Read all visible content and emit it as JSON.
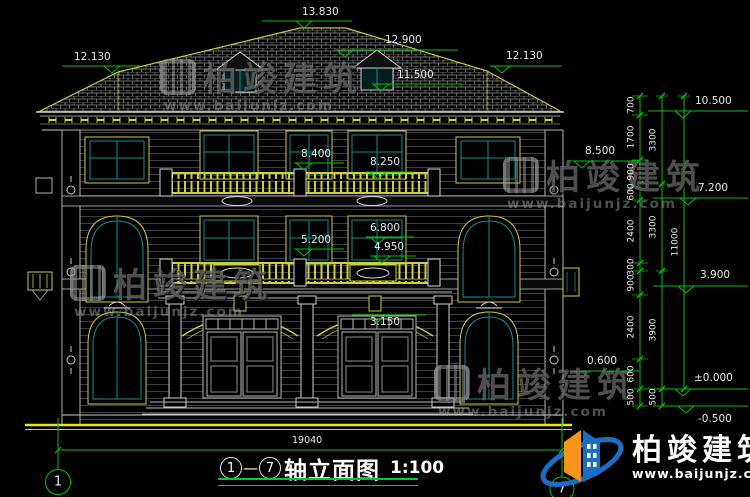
{
  "title": {
    "axis_start": "1",
    "separator": "—",
    "axis_end": "7",
    "name": "轴立面图",
    "scale": "1:100"
  },
  "axes": {
    "left": "1",
    "right": "7"
  },
  "elev": {
    "ridge": "13.830",
    "roof_left": "12.130",
    "roof_right": "12.130",
    "dormer_top": "12.900",
    "dormer_base": "11.500",
    "balcony3_front": "8.400",
    "balcony3_back": "8.250",
    "f2_header": "6.800",
    "f2_sill": "5.200",
    "balcony2": "4.950",
    "entry_arch": "3.150",
    "eave_right": "10.500",
    "r_8500": "8.500",
    "r_7200": "7.200",
    "r_3900": "3.900",
    "r_0600": "0.600",
    "ground": "±0.000",
    "basement": "-0.500"
  },
  "dims": {
    "inner": [
      "700",
      "1700",
      "900",
      "600",
      "2400",
      "300",
      "900",
      "2400",
      "600",
      "500"
    ],
    "mid": [
      "3300",
      "3300",
      "3900",
      "500"
    ],
    "total": "11000",
    "width": "19040"
  },
  "watermark": {
    "brand": "柏竣建筑",
    "url": "www.baijunjz.com"
  },
  "logo": {
    "brand": "柏竣建筑",
    "url": "www.baijunjz.com"
  },
  "colors": {
    "dim_green": "#00c400",
    "cad_yellow": "#cfcf3a",
    "glass_teal": "#0f9090",
    "ground_yellow": "#e8e815",
    "logo_blue": "#1a6fc4",
    "logo_orange": "#f7941d"
  }
}
